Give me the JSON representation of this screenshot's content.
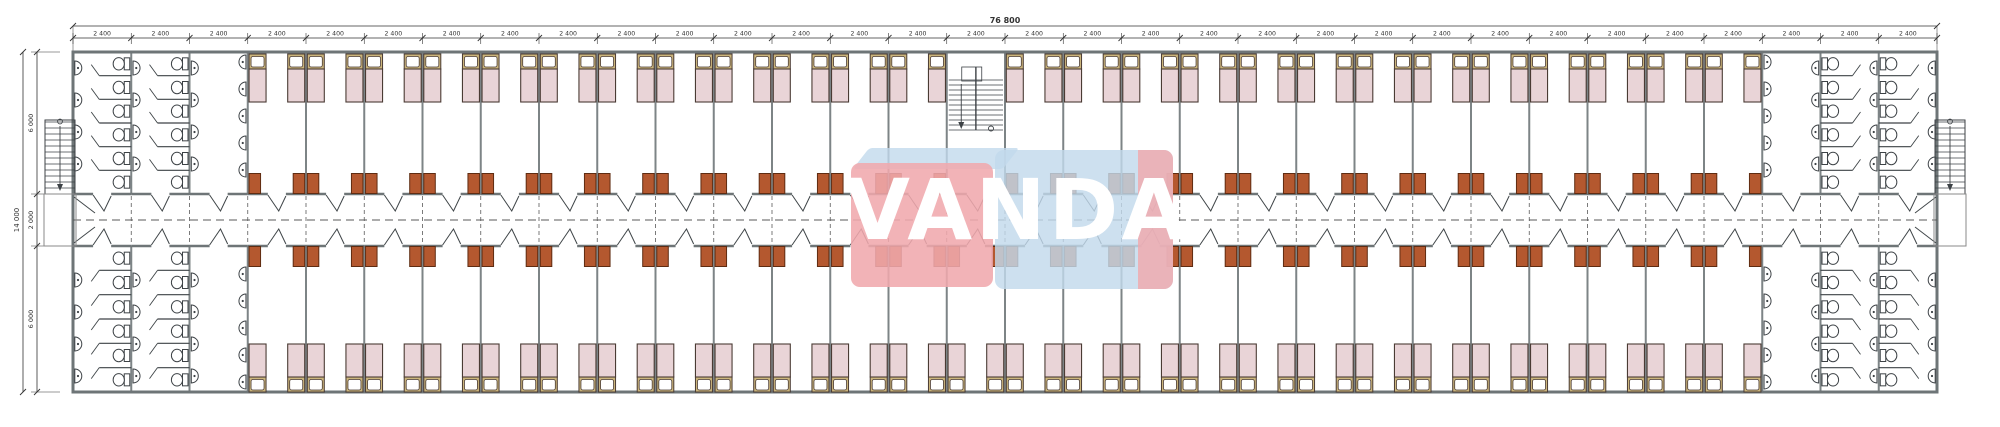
{
  "watermark": {
    "text": "VANDA"
  },
  "dimensions": {
    "total_length": "76 800",
    "bay": "2 400",
    "bay_count": 32,
    "total_height": "14 000",
    "segments": [
      "6 000",
      "2 000",
      "6 000"
    ]
  },
  "layout": {
    "left_bathroom_bays": 3,
    "right_bathroom_bays": 3,
    "stair_bay_index": 15,
    "top_bedrooms": 25,
    "bottom_bedrooms": 26,
    "toilet_stalls_per_bank": 6,
    "sinks_per_wall_column": 4,
    "sinks_per_end_column": 5,
    "beds_per_room": 2
  },
  "colors": {
    "wall": "#6e7577",
    "partition": "#7d8486",
    "bed_fill": "#e9d4d7",
    "bed_stroke": "#4a3b34",
    "headboard": "#cbb57c",
    "pillow": "#ffffff",
    "cabinet": "#b4582f",
    "cabinet_stroke": "#5f2c12",
    "fixture": "#3d4246",
    "door": "#3f4548",
    "dash": "#5a5a5a",
    "dim": "#333333",
    "wm_red": "#f0a8ad",
    "wm_blue": "#c2d9ec",
    "wm_text": "#ffffff"
  }
}
